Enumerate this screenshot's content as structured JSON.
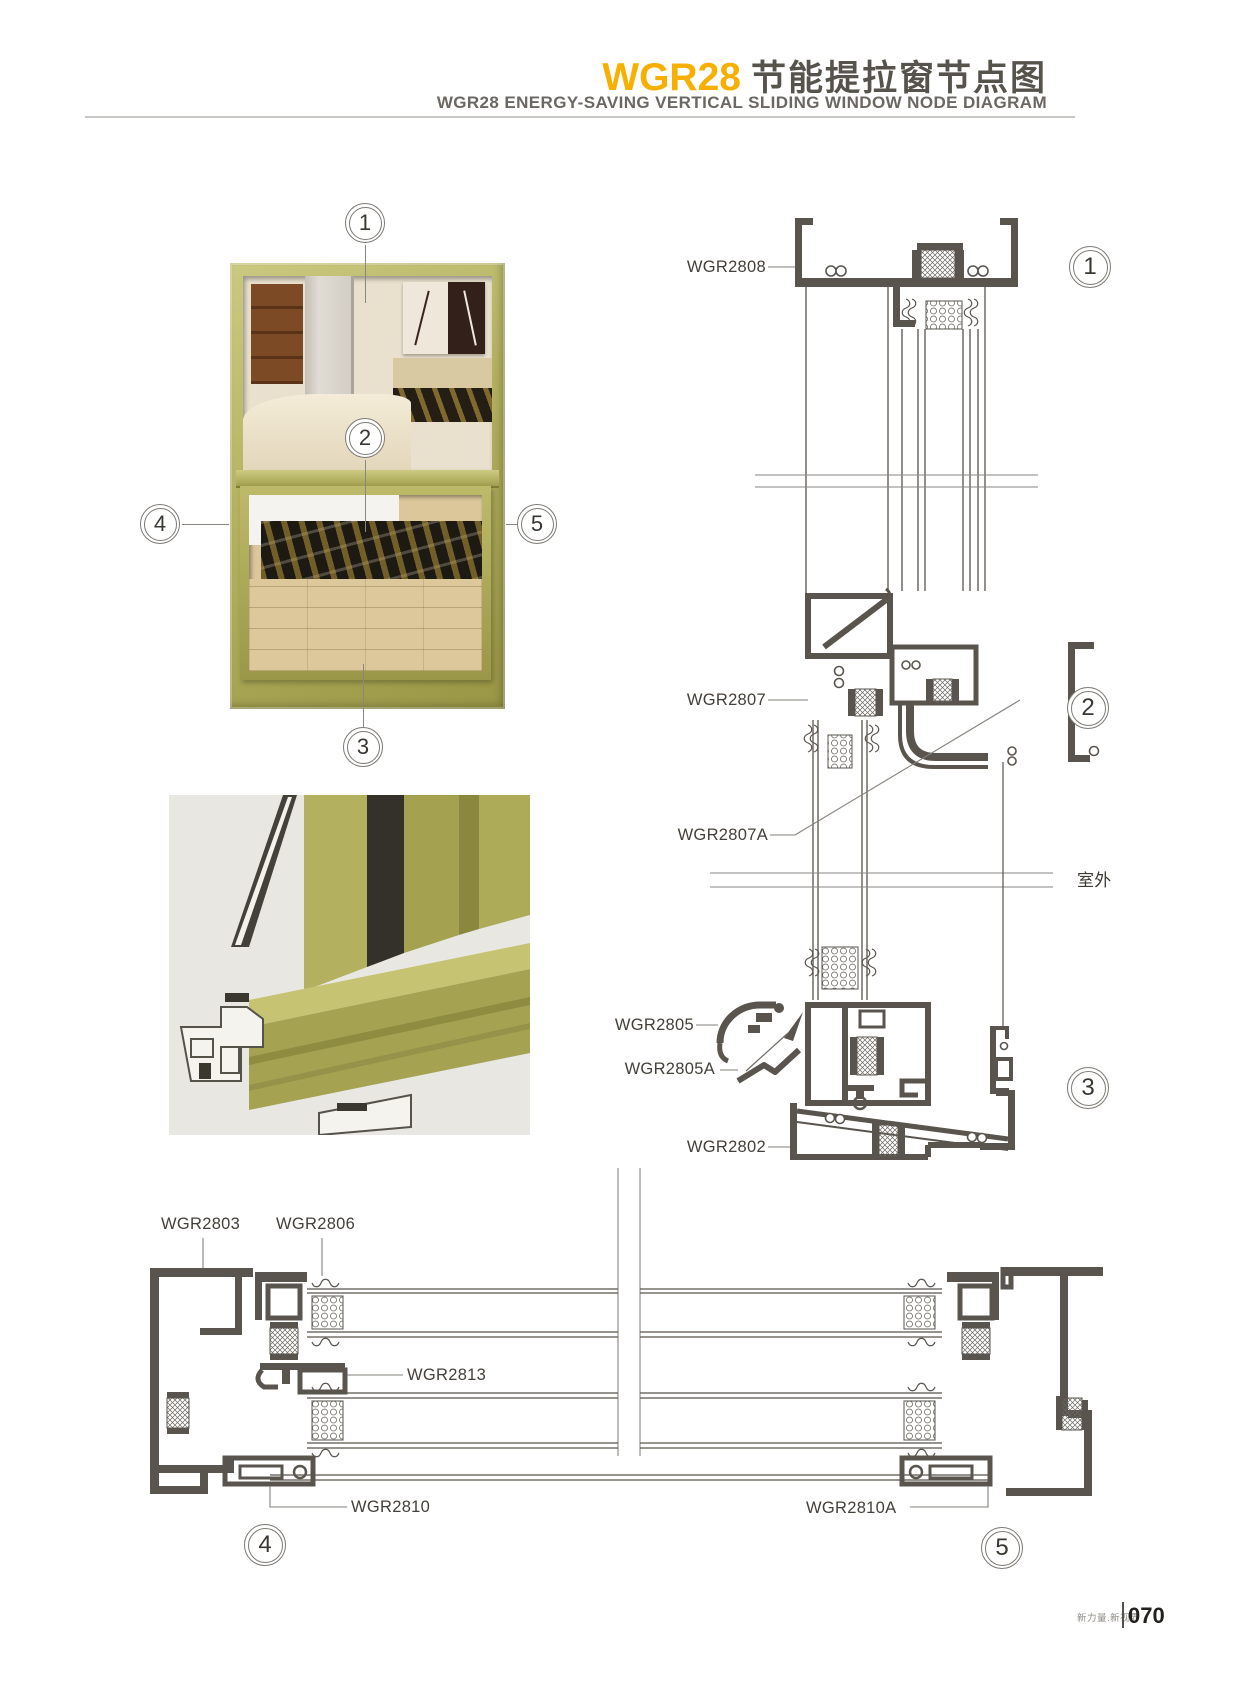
{
  "header": {
    "model": "WGR28",
    "title_cn": "节能提拉窗节点图",
    "subtitle": "WGR28 ENERGY-SAVING VERTICAL SLIDING WINDOW NODE DIAGRAM"
  },
  "photo": {
    "callouts": {
      "c1": "1",
      "c2": "2",
      "c3": "3",
      "c4": "4",
      "c5": "5"
    }
  },
  "vertical_section": {
    "labels": {
      "wgr2808": "WGR2808",
      "wgr2807": "WGR2807",
      "wgr2807a": "WGR2807A",
      "wgr2805": "WGR2805",
      "wgr2805a": "WGR2805A",
      "wgr2802": "WGR2802"
    },
    "outdoor": "室外",
    "callouts": {
      "c1": "1",
      "c2": "2",
      "c3": "3"
    }
  },
  "horizontal_section": {
    "labels": {
      "wgr2803": "WGR2803",
      "wgr2806": "WGR2806",
      "wgr2813": "WGR2813",
      "wgr2810": "WGR2810",
      "wgr2810a": "WGR2810A"
    },
    "callouts": {
      "c4": "4",
      "c5": "5"
    }
  },
  "footer": {
    "slogan": "新力量.新视界",
    "page": "070"
  },
  "colors": {
    "accent": "#F7AF00",
    "ink": "#56524C",
    "line": "#59554E",
    "olive": "#AFAD5C"
  }
}
